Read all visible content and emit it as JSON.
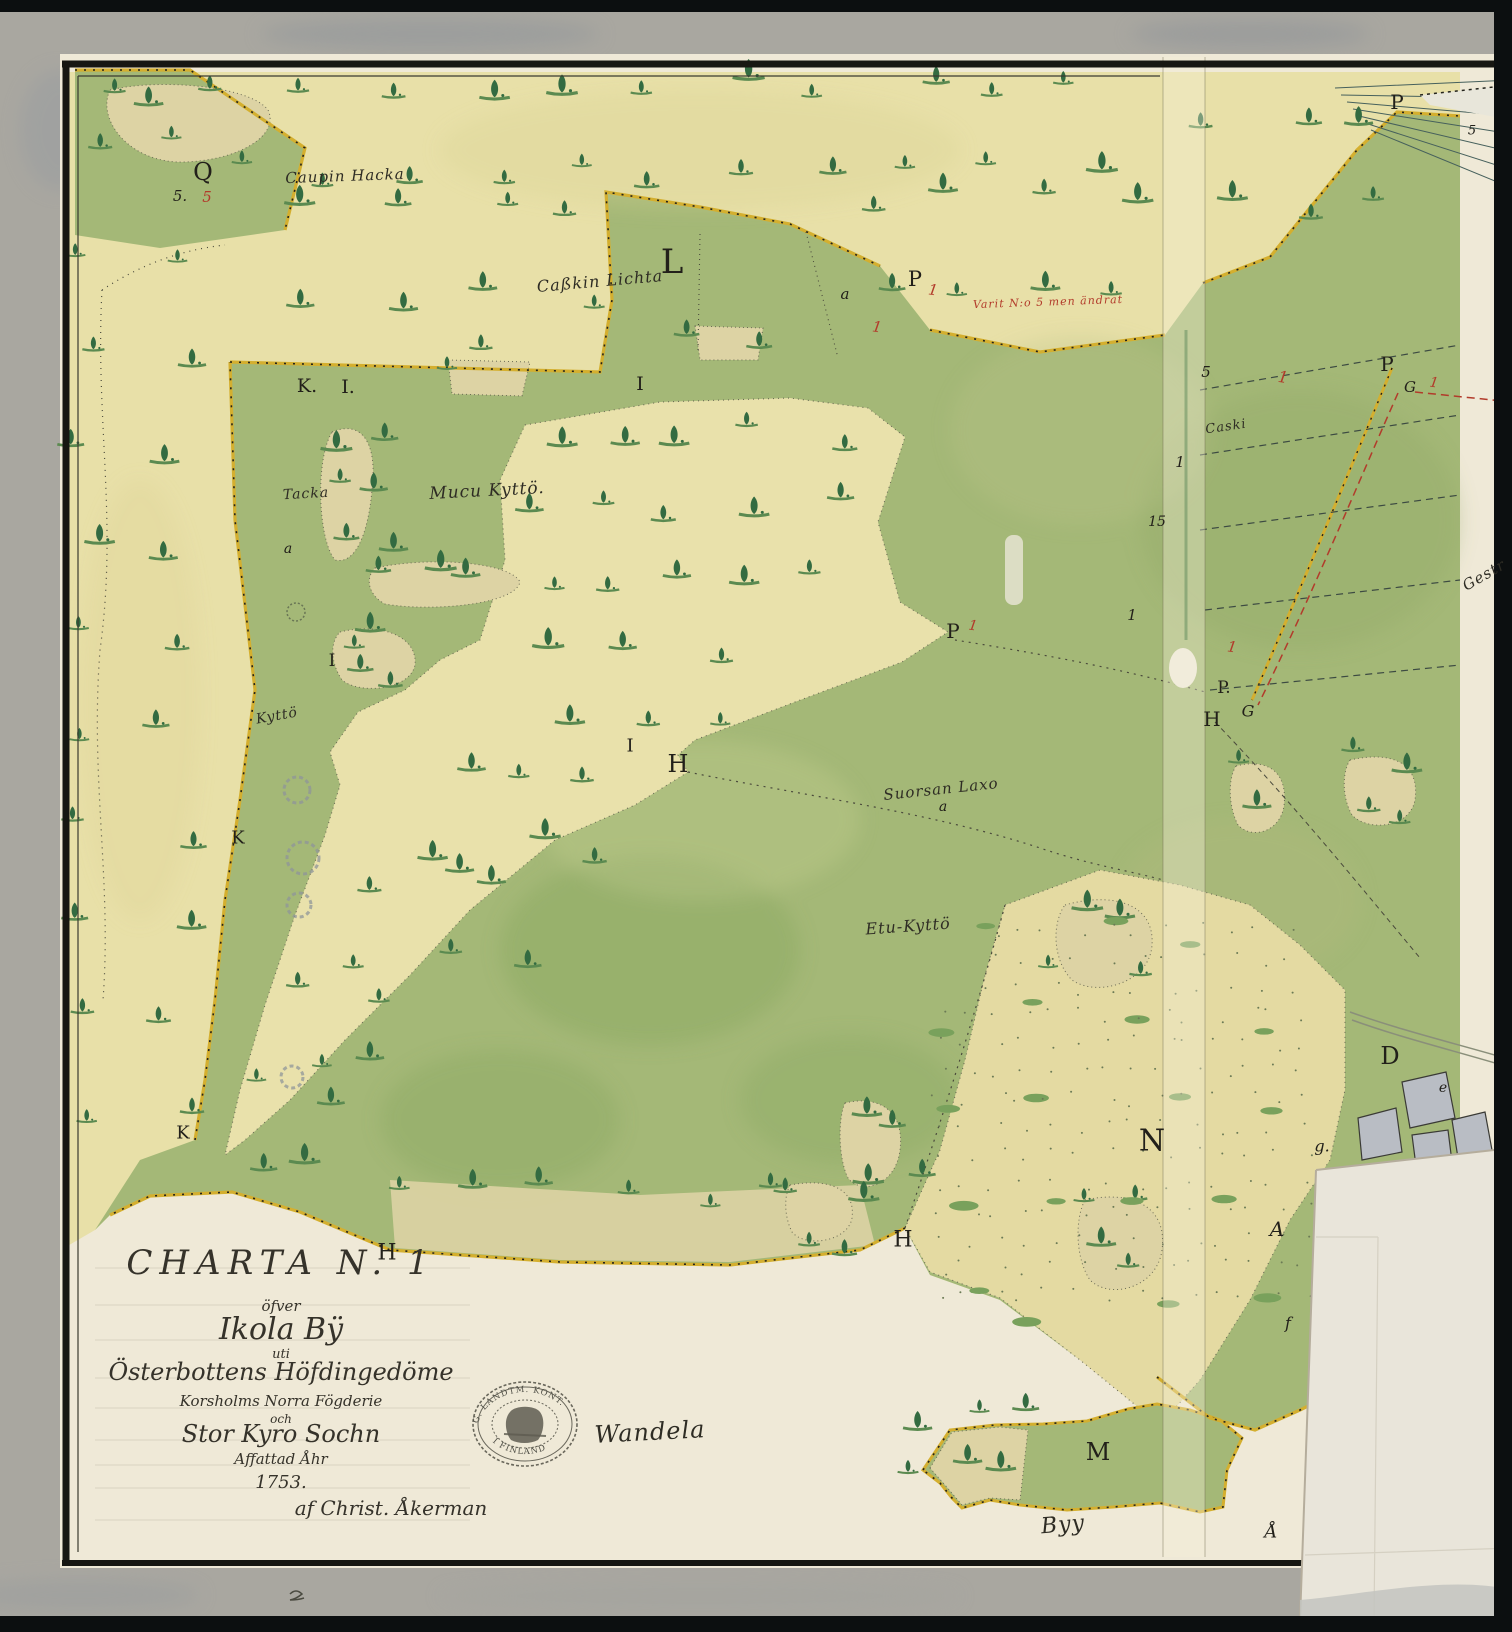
{
  "cartouche": {
    "lines": [
      "CHARTA N. 1",
      "öfver",
      "Ikola Bÿ",
      "uti",
      "Österbottens Höfdingedöme",
      "Korsholms Norra Fögderie",
      "och",
      "Stor Kyro Sochn",
      "Affattad Åhr",
      "1753.",
      "af Christ. Åkerman"
    ]
  },
  "stamp": {
    "arc_top": "G. LANDTM. KONT.",
    "arc_bottom": "I FINLAND"
  },
  "colors": {
    "green": "#a4b877",
    "meadow": "#e8e0a8",
    "tan_island": "#ddd3a4",
    "paper": "#efe9d7",
    "mat": "#a9a7a0",
    "boundary_yellow": "#d4af2f",
    "red_ink": "#b23b2b",
    "black_ink": "#2e2c24"
  },
  "map_labels": [
    {
      "t": "Caupin Hacka",
      "x": 345,
      "y": 176,
      "s": 15,
      "r": -2,
      "c": "b",
      "k": "place"
    },
    {
      "t": "Caßkin Lichta",
      "x": 600,
      "y": 281,
      "s": 16,
      "r": -5,
      "c": "b",
      "k": "place"
    },
    {
      "t": "Tacka",
      "x": 306,
      "y": 494,
      "s": 14,
      "r": -3,
      "c": "b",
      "k": "place"
    },
    {
      "t": "Mucu Kyttö.",
      "x": 487,
      "y": 491,
      "s": 17,
      "r": -3,
      "c": "b",
      "k": "place"
    },
    {
      "t": "Kyttö",
      "x": 277,
      "y": 716,
      "s": 14,
      "r": -10,
      "c": "b",
      "k": "place"
    },
    {
      "t": "Suorsan Laxo",
      "x": 941,
      "y": 789,
      "s": 15,
      "r": -6,
      "c": "b",
      "k": "place"
    },
    {
      "t": "Etu-Kyttö",
      "x": 908,
      "y": 926,
      "s": 16,
      "r": -4,
      "c": "b",
      "k": "place"
    },
    {
      "t": "Caski",
      "x": 1226,
      "y": 427,
      "s": 13,
      "r": -8,
      "c": "b",
      "k": "place"
    },
    {
      "t": "Gestr",
      "x": 1484,
      "y": 575,
      "s": 15,
      "r": -30,
      "c": "b",
      "k": "place"
    },
    {
      "t": "Wandela",
      "x": 650,
      "y": 1432,
      "s": 24,
      "r": -3,
      "c": "b",
      "k": "place"
    },
    {
      "t": "Byy",
      "x": 1063,
      "y": 1525,
      "s": 22,
      "r": -5,
      "c": "b",
      "k": "place"
    },
    {
      "t": "Varit N:o 5 men ändrat",
      "x": 1048,
      "y": 302,
      "s": 11,
      "r": -2,
      "c": "r",
      "k": "place"
    },
    {
      "t": "Q",
      "x": 203,
      "y": 172,
      "s": 24,
      "r": 0,
      "c": "b",
      "k": "letter"
    },
    {
      "t": "5.",
      "x": 180,
      "y": 196,
      "s": 15,
      "r": 0,
      "c": "b",
      "k": "num"
    },
    {
      "t": "5",
      "x": 207,
      "y": 197,
      "s": 15,
      "r": 0,
      "c": "r",
      "k": "num"
    },
    {
      "t": "L",
      "x": 672,
      "y": 262,
      "s": 34,
      "r": 0,
      "c": "b",
      "k": "letter"
    },
    {
      "t": "K.",
      "x": 307,
      "y": 386,
      "s": 19,
      "r": 0,
      "c": "b",
      "k": "letter"
    },
    {
      "t": "I.",
      "x": 348,
      "y": 387,
      "s": 19,
      "r": 0,
      "c": "b",
      "k": "letter"
    },
    {
      "t": "I",
      "x": 640,
      "y": 384,
      "s": 19,
      "r": 0,
      "c": "b",
      "k": "letter"
    },
    {
      "t": "P",
      "x": 915,
      "y": 279,
      "s": 21,
      "r": 0,
      "c": "b",
      "k": "letter"
    },
    {
      "t": "1",
      "x": 933,
      "y": 290,
      "s": 15,
      "r": 8,
      "c": "r",
      "k": "num"
    },
    {
      "t": "1",
      "x": 877,
      "y": 327,
      "s": 15,
      "r": 8,
      "c": "r",
      "k": "num"
    },
    {
      "t": "a",
      "x": 845,
      "y": 294,
      "s": 15,
      "r": 0,
      "c": "b",
      "k": "num"
    },
    {
      "t": "a",
      "x": 288,
      "y": 549,
      "s": 14,
      "r": 0,
      "c": "b",
      "k": "num"
    },
    {
      "t": "I",
      "x": 332,
      "y": 661,
      "s": 17,
      "r": 0,
      "c": "b",
      "k": "letter"
    },
    {
      "t": "I",
      "x": 630,
      "y": 746,
      "s": 18,
      "r": 0,
      "c": "b",
      "k": "letter"
    },
    {
      "t": "H",
      "x": 678,
      "y": 764,
      "s": 24,
      "r": 0,
      "c": "b",
      "k": "letter"
    },
    {
      "t": "P",
      "x": 953,
      "y": 631,
      "s": 20,
      "r": 0,
      "c": "b",
      "k": "letter"
    },
    {
      "t": "1",
      "x": 973,
      "y": 626,
      "s": 14,
      "r": 8,
      "c": "r",
      "k": "num"
    },
    {
      "t": "a",
      "x": 943,
      "y": 807,
      "s": 14,
      "r": 0,
      "c": "b",
      "k": "num"
    },
    {
      "t": "K",
      "x": 238,
      "y": 838,
      "s": 18,
      "r": 0,
      "c": "b",
      "k": "letter"
    },
    {
      "t": "K",
      "x": 183,
      "y": 1133,
      "s": 18,
      "r": 0,
      "c": "b",
      "k": "letter"
    },
    {
      "t": "H",
      "x": 387,
      "y": 1253,
      "s": 22,
      "r": 0,
      "c": "b",
      "k": "letter"
    },
    {
      "t": "H",
      "x": 903,
      "y": 1240,
      "s": 22,
      "r": 0,
      "c": "b",
      "k": "letter"
    },
    {
      "t": "N",
      "x": 1152,
      "y": 1141,
      "s": 30,
      "r": 0,
      "c": "b",
      "k": "letter"
    },
    {
      "t": "M",
      "x": 1098,
      "y": 1452,
      "s": 24,
      "r": 0,
      "c": "b",
      "k": "letter"
    },
    {
      "t": "D",
      "x": 1390,
      "y": 1056,
      "s": 24,
      "r": 0,
      "c": "b",
      "k": "letter"
    },
    {
      "t": "e",
      "x": 1443,
      "y": 1088,
      "s": 14,
      "r": 0,
      "c": "b",
      "k": "num"
    },
    {
      "t": "g.",
      "x": 1322,
      "y": 1146,
      "s": 16,
      "r": 0,
      "c": "b",
      "k": "num"
    },
    {
      "t": "A",
      "x": 1277,
      "y": 1229,
      "s": 20,
      "r": 0,
      "c": "b",
      "k": "num"
    },
    {
      "t": "f",
      "x": 1288,
      "y": 1323,
      "s": 16,
      "r": 0,
      "c": "b",
      "k": "num"
    },
    {
      "t": "Å",
      "x": 1271,
      "y": 1532,
      "s": 18,
      "r": 0,
      "c": "b",
      "k": "num"
    },
    {
      "t": "5",
      "x": 1206,
      "y": 372,
      "s": 15,
      "r": 0,
      "c": "b",
      "k": "num"
    },
    {
      "t": "1",
      "x": 1180,
      "y": 462,
      "s": 15,
      "r": 0,
      "c": "b",
      "k": "num"
    },
    {
      "t": "15",
      "x": 1157,
      "y": 522,
      "s": 14,
      "r": 0,
      "c": "b",
      "k": "num"
    },
    {
      "t": "1",
      "x": 1132,
      "y": 615,
      "s": 15,
      "r": 0,
      "c": "b",
      "k": "num"
    },
    {
      "t": "1",
      "x": 1232,
      "y": 647,
      "s": 15,
      "r": 8,
      "c": "r",
      "k": "num"
    },
    {
      "t": "P.",
      "x": 1224,
      "y": 688,
      "s": 17,
      "r": 0,
      "c": "b",
      "k": "letter"
    },
    {
      "t": "H",
      "x": 1212,
      "y": 719,
      "s": 20,
      "r": 0,
      "c": "b",
      "k": "letter"
    },
    {
      "t": "G",
      "x": 1248,
      "y": 711,
      "s": 16,
      "r": 0,
      "c": "b",
      "k": "num"
    },
    {
      "t": "P",
      "x": 1387,
      "y": 364,
      "s": 20,
      "r": 0,
      "c": "b",
      "k": "letter"
    },
    {
      "t": "G",
      "x": 1410,
      "y": 387,
      "s": 15,
      "r": 0,
      "c": "b",
      "k": "num"
    },
    {
      "t": "1",
      "x": 1434,
      "y": 383,
      "s": 14,
      "r": 8,
      "c": "r",
      "k": "num"
    },
    {
      "t": "1",
      "x": 1283,
      "y": 377,
      "s": 16,
      "r": 8,
      "c": "r",
      "k": "num"
    },
    {
      "t": "P",
      "x": 1397,
      "y": 102,
      "s": 20,
      "r": 0,
      "c": "b",
      "k": "letter"
    },
    {
      "t": "5",
      "x": 1472,
      "y": 131,
      "s": 13,
      "r": 0,
      "c": "b",
      "k": "num"
    }
  ]
}
